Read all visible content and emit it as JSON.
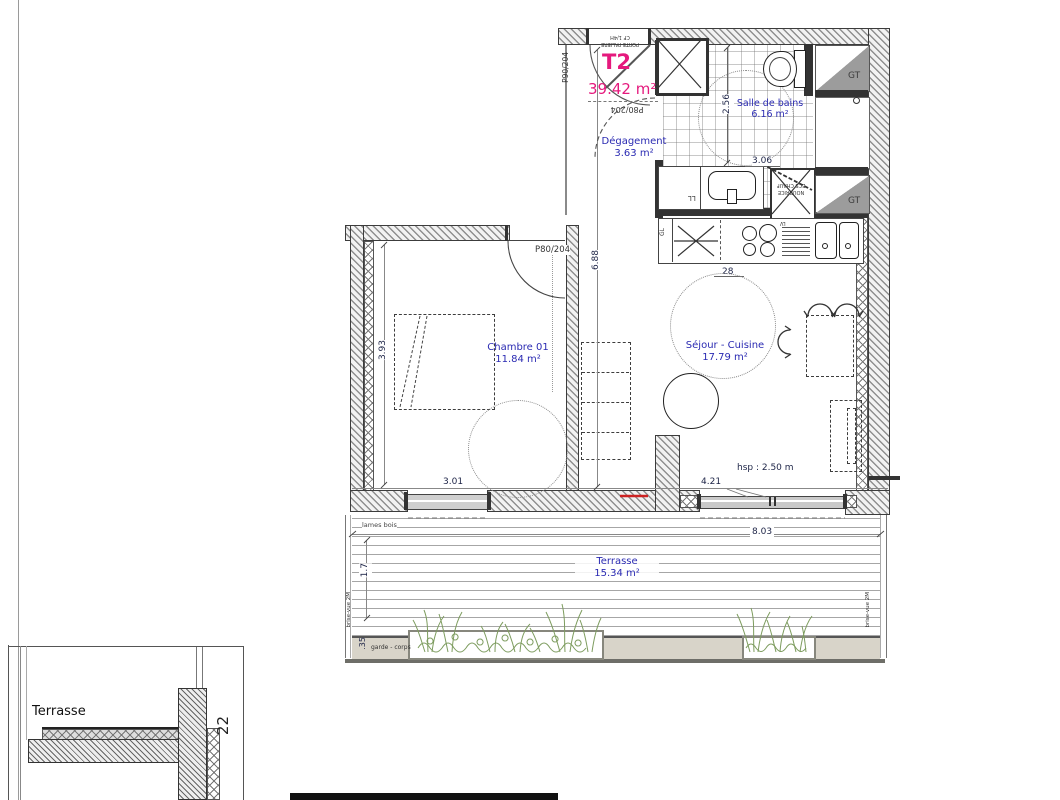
{
  "title": {
    "code": "T2",
    "area": "39.42 m²"
  },
  "entry": {
    "door_label": "P90/204",
    "door_note1": "PORTE PALIERE",
    "door_note2": "CF 1/4H",
    "hall_door_label": "P80/204"
  },
  "rooms": {
    "degagement": {
      "name": "Dégagement",
      "area": "3.63 m²"
    },
    "bains": {
      "name": "Salle de bains",
      "area": "6.16 m²"
    },
    "chambre": {
      "name": "Chambre 01",
      "area": "11.84 m²"
    },
    "sejour": {
      "name": "Séjour - Cuisine",
      "area": "17.79 m²"
    },
    "terrasse": {
      "name": "Terrasse",
      "area": "15.34 m²"
    }
  },
  "doors": {
    "chambre": "P80/204"
  },
  "dims": {
    "bath_w": "2.56",
    "bath_d": "3.06",
    "corridor": "6.88",
    "chambre_h": "3.93",
    "chambre_w": "3.01",
    "bay": "4.21",
    "counter": "28",
    "ceiling": "hsp : 2.50 m",
    "terrasse_w": "8.03",
    "terrasse_d": "1.7",
    "guard": ".35",
    "detail": "22"
  },
  "labels": {
    "gt1": "GT",
    "gt2": "GT",
    "gl": "GL",
    "ll": "LL",
    "lv": "LV",
    "nourrice1": "NOURRICE",
    "nourrice2": "ECS CHAUF",
    "lames_bois": "lames bois",
    "brise_vue": "brise-vue 2M",
    "garde_corps": "garde - corps",
    "detail_title": "Terrasse"
  },
  "colors": {
    "pink": "#e5197d",
    "room_blue": "#2a2ab2",
    "dim_navy": "#1c2346",
    "plant_green": "#7d9c5e",
    "red_mark": "#cc2222"
  }
}
